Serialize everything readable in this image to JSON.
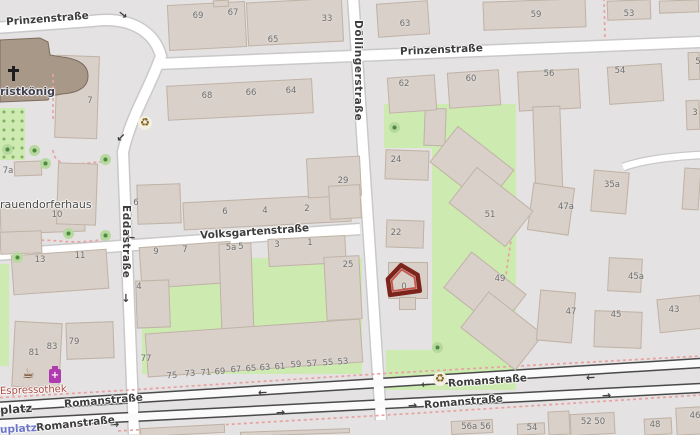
{
  "map": {
    "kind": "street-map-viewport",
    "colors": {
      "background": "#e4e2e2",
      "building_fill": "#d9d0c9",
      "building_stroke": "#c0b3a6",
      "church_fill": "#a89888",
      "church_stroke": "#7d6b5d",
      "park_green": "#cdebb0",
      "road_fill": "#ffffff",
      "road_casing_minor": "#c9c9c9",
      "road_casing_major": "#4a4a4a",
      "footpath_pink": "#e8a2a2",
      "street_label": "#3d3d3d",
      "house_number": "#6f6f6f",
      "poi_label_red": "#ad4a42",
      "transit_label_blue": "#6b74c9",
      "marker_red_outer": "#7c241c",
      "marker_red_inner": "#c4574d",
      "chemist_magenta": "#b03bb0",
      "cafe_brown": "#6b4423",
      "recycle_brown": "#7d5f15"
    },
    "street_labels": [
      {
        "t": "Prinzenstraße",
        "x": 6,
        "y": 13,
        "r": -4.5,
        "cls": ""
      },
      {
        "t": "Prinzenstraße",
        "x": 400,
        "y": 44,
        "r": -2.5,
        "cls": ""
      },
      {
        "t": "Döllingerstraße",
        "x": 364,
        "y": 20,
        "r": 90,
        "cls": "vertical"
      },
      {
        "t": "Eddastraße",
        "x": 132,
        "y": 205,
        "r": 90,
        "cls": "vertical"
      },
      {
        "t": "Volksgartenstraße",
        "x": 200,
        "y": 226,
        "r": -4,
        "cls": ""
      },
      {
        "t": "Romanstraße",
        "x": 64,
        "y": 395,
        "r": -5,
        "cls": ""
      },
      {
        "t": "Romanstraße",
        "x": 448,
        "y": 375,
        "r": -4,
        "cls": ""
      },
      {
        "t": "Romanstraße",
        "x": 36,
        "y": 418,
        "r": -6,
        "cls": ""
      },
      {
        "t": "Romanstraße",
        "x": 424,
        "y": 396,
        "r": -5,
        "cls": ""
      },
      {
        "t": "platz",
        "x": 0,
        "y": 402,
        "r": -4,
        "cls": "street-bold"
      }
    ],
    "place_labels": [
      {
        "t": "ristkönig",
        "x": 0,
        "y": 85,
        "r": 0,
        "cls": "church-name"
      },
      {
        "t": "rauendorferhaus",
        "x": 0,
        "y": 198,
        "r": 0,
        "cls": "place-name"
      },
      {
        "t": "Espressothek",
        "x": 0,
        "y": 385,
        "r": -2,
        "cls": "poi-name"
      },
      {
        "t": "uplatz",
        "x": 0,
        "y": 423,
        "r": -3,
        "cls": "transit-name"
      }
    ],
    "house_numbers": [
      {
        "t": "69",
        "x": 198,
        "y": 16
      },
      {
        "t": "67",
        "x": 233,
        "y": 13
      },
      {
        "t": "33",
        "x": 327,
        "y": 19
      },
      {
        "t": "65",
        "x": 273,
        "y": 40
      },
      {
        "t": "63",
        "x": 405,
        "y": 24
      },
      {
        "t": "59",
        "x": 536,
        "y": 15
      },
      {
        "t": "53",
        "x": 629,
        "y": 14
      },
      {
        "t": "5",
        "x": 698,
        "y": 62
      },
      {
        "t": "3",
        "x": 695,
        "y": 113
      },
      {
        "t": "7",
        "x": 90,
        "y": 101
      },
      {
        "t": "62",
        "x": 404,
        "y": 84
      },
      {
        "t": "60",
        "x": 471,
        "y": 79
      },
      {
        "t": "56",
        "x": 549,
        "y": 74
      },
      {
        "t": "54",
        "x": 620,
        "y": 71
      },
      {
        "t": "7a",
        "x": 8,
        "y": 171
      },
      {
        "t": "68",
        "x": 207,
        "y": 96
      },
      {
        "t": "66",
        "x": 251,
        "y": 93
      },
      {
        "t": "64",
        "x": 291,
        "y": 91
      },
      {
        "t": "10",
        "x": 57,
        "y": 215
      },
      {
        "t": "6",
        "x": 136,
        "y": 203
      },
      {
        "t": "29",
        "x": 343,
        "y": 181
      },
      {
        "t": "24",
        "x": 396,
        "y": 160
      },
      {
        "t": "22",
        "x": 396,
        "y": 233
      },
      {
        "t": "13",
        "x": 40,
        "y": 260
      },
      {
        "t": "11",
        "x": 80,
        "y": 256
      },
      {
        "t": "6",
        "x": 225,
        "y": 212
      },
      {
        "t": "4",
        "x": 265,
        "y": 211
      },
      {
        "t": "2",
        "x": 307,
        "y": 209
      },
      {
        "t": "9",
        "x": 156,
        "y": 252
      },
      {
        "t": "7",
        "x": 185,
        "y": 250
      },
      {
        "t": "5a",
        "x": 231,
        "y": 248
      },
      {
        "t": "5",
        "x": 241,
        "y": 247
      },
      {
        "t": "3",
        "x": 277,
        "y": 245
      },
      {
        "t": "1",
        "x": 310,
        "y": 243
      },
      {
        "t": "25",
        "x": 348,
        "y": 265
      },
      {
        "t": "4",
        "x": 139,
        "y": 287
      },
      {
        "t": "51",
        "x": 490,
        "y": 215
      },
      {
        "t": "35a",
        "x": 612,
        "y": 185
      },
      {
        "t": "47a",
        "x": 566,
        "y": 207
      },
      {
        "t": "49",
        "x": 500,
        "y": 279
      },
      {
        "t": "45a",
        "x": 636,
        "y": 277
      },
      {
        "t": "0",
        "x": 404,
        "y": 287
      },
      {
        "t": "77",
        "x": 146,
        "y": 359
      },
      {
        "t": "75",
        "x": 172,
        "y": 376,
        "r": -4
      },
      {
        "t": "73",
        "x": 190,
        "y": 374,
        "r": -4
      },
      {
        "t": "71",
        "x": 206,
        "y": 373,
        "r": -4
      },
      {
        "t": "69",
        "x": 220,
        "y": 372,
        "r": -4
      },
      {
        "t": "67",
        "x": 236,
        "y": 370,
        "r": -4
      },
      {
        "t": "65",
        "x": 251,
        "y": 369,
        "r": -4
      },
      {
        "t": "63",
        "x": 265,
        "y": 368,
        "r": -4
      },
      {
        "t": "61",
        "x": 280,
        "y": 367,
        "r": -4
      },
      {
        "t": "59",
        "x": 296,
        "y": 365,
        "r": -4
      },
      {
        "t": "57",
        "x": 312,
        "y": 364,
        "r": -4
      },
      {
        "t": "55",
        "x": 328,
        "y": 363,
        "r": -4
      },
      {
        "t": "53",
        "x": 343,
        "y": 362,
        "r": -4
      },
      {
        "t": "81",
        "x": 34,
        "y": 353
      },
      {
        "t": "83",
        "x": 52,
        "y": 347
      },
      {
        "t": "79",
        "x": 74,
        "y": 342
      },
      {
        "t": "47",
        "x": 571,
        "y": 312
      },
      {
        "t": "45",
        "x": 616,
        "y": 315
      },
      {
        "t": "43",
        "x": 674,
        "y": 310
      },
      {
        "t": "56a 56",
        "x": 476,
        "y": 427
      },
      {
        "t": "54",
        "x": 532,
        "y": 428
      },
      {
        "t": "52 50",
        "x": 593,
        "y": 422
      },
      {
        "t": "48",
        "x": 655,
        "y": 425
      },
      {
        "t": "46",
        "x": 695,
        "y": 416
      }
    ],
    "oneway_arrows": [
      {
        "g": "→",
        "x": 118,
        "y": 10,
        "r": 38
      },
      {
        "g": "→",
        "x": 116,
        "y": 132,
        "r": 135
      },
      {
        "g": "→",
        "x": 121,
        "y": 293,
        "r": 90
      },
      {
        "g": "←",
        "x": 290,
        "y": 226,
        "r": -3
      },
      {
        "g": "←",
        "x": 126,
        "y": 233,
        "r": 3
      },
      {
        "g": "←",
        "x": 132,
        "y": 394,
        "r": -3
      },
      {
        "g": "←",
        "x": 258,
        "y": 388,
        "r": -3
      },
      {
        "g": "←",
        "x": 421,
        "y": 380,
        "r": -3
      },
      {
        "g": "←",
        "x": 586,
        "y": 373,
        "r": -3
      },
      {
        "g": "→",
        "x": 276,
        "y": 408,
        "r": -3
      },
      {
        "g": "→",
        "x": 408,
        "y": 401,
        "r": -3
      },
      {
        "g": "→",
        "x": 602,
        "y": 391,
        "r": -3
      },
      {
        "g": "→",
        "x": 110,
        "y": 420,
        "r": -3
      }
    ],
    "greens": [
      {
        "x": 0,
        "y": 108,
        "w": 25,
        "h": 52,
        "orchard": true
      },
      {
        "x": 0,
        "y": 264,
        "w": 9,
        "h": 102
      },
      {
        "x": 142,
        "y": 258,
        "w": 220,
        "h": 116
      },
      {
        "x": 384,
        "y": 104,
        "w": 132,
        "h": 44
      },
      {
        "x": 432,
        "y": 148,
        "w": 84,
        "h": 202
      },
      {
        "x": 386,
        "y": 350,
        "w": 130,
        "h": 40
      }
    ],
    "trees": [
      {
        "x": 7,
        "y": 149
      },
      {
        "x": 34,
        "y": 150
      },
      {
        "x": 45,
        "y": 163
      },
      {
        "x": 105,
        "y": 159
      },
      {
        "x": 17,
        "y": 257
      },
      {
        "x": 68,
        "y": 233
      },
      {
        "x": 105,
        "y": 235
      },
      {
        "x": 394,
        "y": 127
      },
      {
        "x": 437,
        "y": 347
      }
    ],
    "recycling": [
      {
        "x": 138,
        "y": 116
      },
      {
        "x": 433,
        "y": 372
      }
    ],
    "pois": [
      {
        "name": "cafe-icon",
        "x": 22,
        "y": 367
      },
      {
        "name": "chemist-icon",
        "x": 49,
        "y": 369
      },
      {
        "name": "church-cross-icon",
        "x": 12,
        "y": 66
      }
    ],
    "buildings": [
      {
        "x": 168,
        "y": 3,
        "w": 78,
        "h": 46,
        "r": -3
      },
      {
        "x": 247,
        "y": 0,
        "w": 96,
        "h": 44,
        "r": -3
      },
      {
        "x": 213,
        "y": 0,
        "w": 16,
        "h": 7,
        "r": -3
      },
      {
        "x": 377,
        "y": 2,
        "w": 52,
        "h": 34,
        "r": -4
      },
      {
        "x": 483,
        "y": 0,
        "w": 103,
        "h": 29,
        "r": -2
      },
      {
        "x": 607,
        "y": 0,
        "w": 44,
        "h": 20,
        "r": -2
      },
      {
        "x": 659,
        "y": 0,
        "w": 40,
        "h": 13,
        "r": -2
      },
      {
        "x": 167,
        "y": 82,
        "w": 146,
        "h": 35,
        "r": -3
      },
      {
        "x": 14,
        "y": 161,
        "w": 28,
        "h": 15,
        "r": -2
      },
      {
        "x": 0,
        "y": 203,
        "w": 85,
        "h": 30,
        "r": -2
      },
      {
        "x": 0,
        "y": 231,
        "w": 42,
        "h": 23,
        "r": -2
      },
      {
        "x": 57,
        "y": 163,
        "w": 40,
        "h": 62,
        "r": 2
      },
      {
        "x": 137,
        "y": 184,
        "w": 44,
        "h": 40,
        "r": -2
      },
      {
        "x": 183,
        "y": 198,
        "w": 168,
        "h": 28,
        "r": -3
      },
      {
        "x": 307,
        "y": 157,
        "w": 54,
        "h": 40,
        "r": -3
      },
      {
        "x": 329,
        "y": 185,
        "w": 32,
        "h": 34,
        "r": -3
      },
      {
        "x": 12,
        "y": 252,
        "w": 96,
        "h": 40,
        "r": -4
      },
      {
        "x": 140,
        "y": 244,
        "w": 92,
        "h": 42,
        "r": -4
      },
      {
        "x": 136,
        "y": 280,
        "w": 34,
        "h": 48,
        "r": -2
      },
      {
        "x": 220,
        "y": 243,
        "w": 33,
        "h": 96,
        "r": -2
      },
      {
        "x": 268,
        "y": 237,
        "w": 78,
        "h": 28,
        "r": -3
      },
      {
        "x": 325,
        "y": 256,
        "w": 36,
        "h": 64,
        "r": -3
      },
      {
        "x": 146,
        "y": 326,
        "w": 216,
        "h": 44,
        "r": -4
      },
      {
        "x": 13,
        "y": 322,
        "w": 48,
        "h": 66,
        "r": 3
      },
      {
        "x": 66,
        "y": 322,
        "w": 48,
        "h": 37,
        "r": -2
      },
      {
        "x": 385,
        "y": 150,
        "w": 44,
        "h": 30,
        "r": 2
      },
      {
        "x": 386,
        "y": 220,
        "w": 38,
        "h": 28,
        "r": 2
      },
      {
        "x": 424,
        "y": 108,
        "w": 22,
        "h": 38,
        "r": 2
      },
      {
        "x": 518,
        "y": 70,
        "w": 62,
        "h": 40,
        "r": -3
      },
      {
        "x": 534,
        "y": 106,
        "w": 28,
        "h": 98,
        "r": -2
      },
      {
        "x": 608,
        "y": 65,
        "w": 55,
        "h": 38,
        "r": -4
      },
      {
        "x": 388,
        "y": 76,
        "w": 48,
        "h": 36,
        "r": -4
      },
      {
        "x": 448,
        "y": 71,
        "w": 52,
        "h": 36,
        "r": -4
      },
      {
        "x": 688,
        "y": 52,
        "w": 12,
        "h": 28,
        "r": -2
      },
      {
        "x": 686,
        "y": 100,
        "w": 14,
        "h": 30,
        "r": -2
      },
      {
        "x": 530,
        "y": 185,
        "w": 42,
        "h": 48,
        "r": 8
      },
      {
        "x": 592,
        "y": 171,
        "w": 36,
        "h": 42,
        "r": 5
      },
      {
        "x": 608,
        "y": 258,
        "w": 34,
        "h": 34,
        "r": 3
      },
      {
        "x": 683,
        "y": 168,
        "w": 17,
        "h": 42,
        "r": 4
      },
      {
        "x": 436,
        "y": 143,
        "w": 72,
        "h": 46,
        "r": 38
      },
      {
        "x": 455,
        "y": 184,
        "w": 72,
        "h": 46,
        "r": 38
      },
      {
        "x": 450,
        "y": 268,
        "w": 70,
        "h": 46,
        "r": 38
      },
      {
        "x": 467,
        "y": 308,
        "w": 70,
        "h": 46,
        "r": 38
      },
      {
        "x": 538,
        "y": 291,
        "w": 36,
        "h": 51,
        "r": 5
      },
      {
        "x": 594,
        "y": 311,
        "w": 48,
        "h": 37,
        "r": 2
      },
      {
        "x": 658,
        "y": 297,
        "w": 44,
        "h": 34,
        "r": -6
      },
      {
        "x": 451,
        "y": 420,
        "w": 42,
        "h": 14,
        "r": -3
      },
      {
        "x": 517,
        "y": 423,
        "w": 28,
        "h": 12,
        "r": -3
      },
      {
        "x": 548,
        "y": 411,
        "w": 22,
        "h": 24,
        "r": -3
      },
      {
        "x": 570,
        "y": 413,
        "w": 45,
        "h": 22,
        "r": -3
      },
      {
        "x": 644,
        "y": 418,
        "w": 28,
        "h": 17,
        "r": -3
      },
      {
        "x": 676,
        "y": 407,
        "w": 26,
        "h": 28,
        "r": -3
      },
      {
        "x": 140,
        "y": 426,
        "w": 85,
        "h": 9,
        "r": -3
      },
      {
        "x": 240,
        "y": 430,
        "w": 110,
        "h": 5,
        "r": -2
      },
      {
        "x": 388,
        "y": 262,
        "w": 40,
        "h": 37,
        "r": 0
      },
      {
        "x": 399,
        "y": 297,
        "w": 17,
        "h": 13,
        "r": 0
      }
    ],
    "geo": {
      "under_buildings": [
        {
          "x": 56,
          "y": 56,
          "w": 42,
          "h": 82,
          "r": 2
        }
      ],
      "church_path": "M 0 40 L 40 38 L 48 42 L 50 55 L 62 57 Q 88 60 88 76 Q 88 92 62 94 L 50 96 L 48 100 L 0 102 Z",
      "roads_minor": [
        "M -6 28 L 92 21 C 128 16 154 30 161 56 C 149 90 131 116 123 152 L 134 434",
        "M 156 64 L 700 42",
        "M 353 -4 L 381 420",
        "M -6 255 L 360 229"
      ],
      "road_service": "M 701 155 C 664 157 640 161 623 167",
      "roads_major": [
        "M -6 407 L 701 363",
        "M -6 424 L 701 388"
      ],
      "footpaths": [
        "M 53 74 L 53 120",
        "M 53 150 Q 54 166 78 164 L 110 161",
        "M 0 247 Q 30 238 58 241 Q 88 244 113 237",
        "M 604 -2 L 605 38",
        "M 517 212 Q 505 265 504 305 Q 504 336 513 353",
        "M -6 398 L 130 390 L 392 373 L 701 356",
        "M 118 431 L 420 413 L 701 395"
      ]
    },
    "marker": {
      "name": "selected-building-home-marker",
      "x": 385,
      "y": 262,
      "w": 36,
      "h": 34,
      "rot": -8,
      "outer_path": "M 18 3 L 33 15 L 33 31 L 3 31 L 3 15 Z",
      "inner_path": "M 18 7.5 L 29.5 17 L 29.5 27.5 L 6.5 27.5 L 6.5 17 Z"
    }
  }
}
